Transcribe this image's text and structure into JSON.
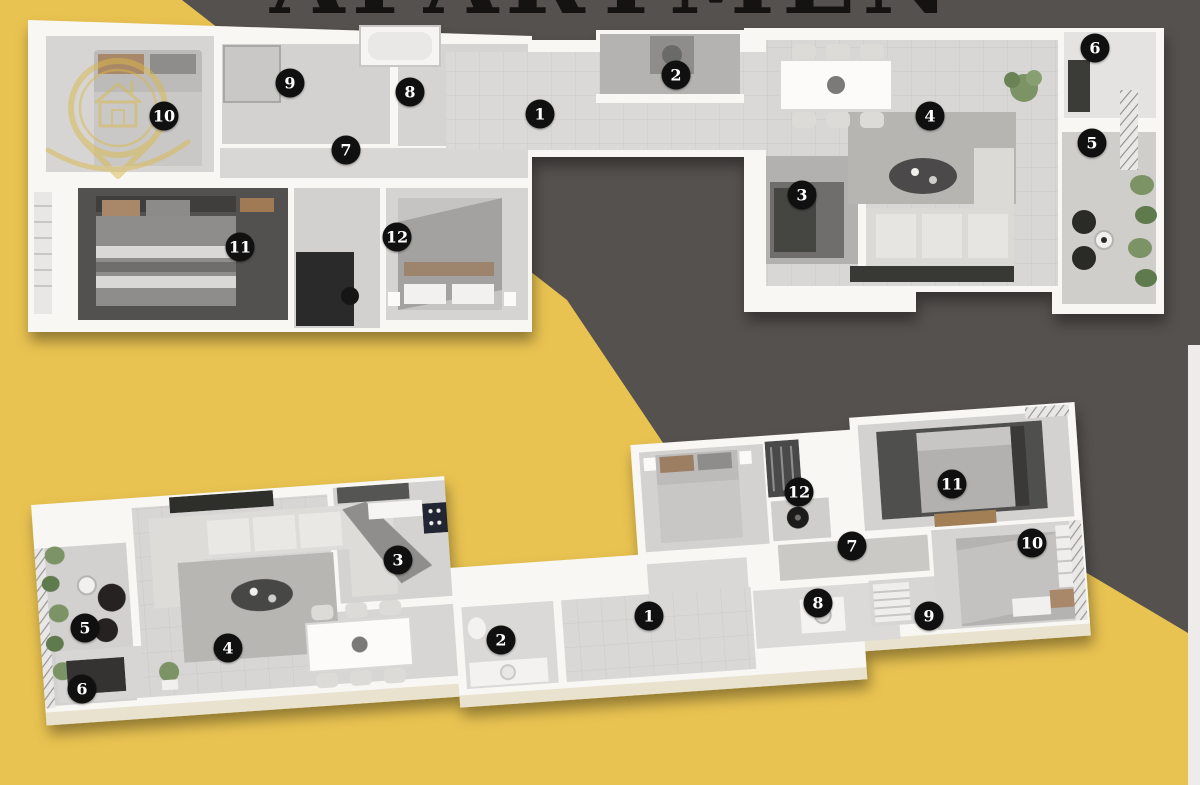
{
  "header": {
    "cropped_title_text": "APARTMENTS"
  },
  "watermark": {
    "icon": "location-pin-house-logo",
    "color": "#d9b94b"
  },
  "palette": {
    "background_yellow": "#e9c351",
    "background_dark": "#55514e",
    "right_edge_strip": "#edecea",
    "slab_white": "#f8f7f4",
    "marker_bg": "#101010",
    "marker_text": "#ffffff"
  },
  "top_plan": {
    "markers": [
      {
        "n": "1",
        "x": 540,
        "y": 114
      },
      {
        "n": "2",
        "x": 676,
        "y": 75
      },
      {
        "n": "3",
        "x": 802,
        "y": 195
      },
      {
        "n": "4",
        "x": 930,
        "y": 116
      },
      {
        "n": "5",
        "x": 1092,
        "y": 143
      },
      {
        "n": "6",
        "x": 1095,
        "y": 48
      },
      {
        "n": "7",
        "x": 346,
        "y": 150
      },
      {
        "n": "8",
        "x": 410,
        "y": 92
      },
      {
        "n": "9",
        "x": 290,
        "y": 83
      },
      {
        "n": "10",
        "x": 164,
        "y": 116
      },
      {
        "n": "11",
        "x": 240,
        "y": 247
      },
      {
        "n": "12",
        "x": 397,
        "y": 237
      }
    ]
  },
  "bottom_plan": {
    "markers": [
      {
        "n": "1",
        "x": 649,
        "y": 616
      },
      {
        "n": "2",
        "x": 501,
        "y": 640
      },
      {
        "n": "3",
        "x": 398,
        "y": 560
      },
      {
        "n": "4",
        "x": 228,
        "y": 648
      },
      {
        "n": "5",
        "x": 85,
        "y": 628
      },
      {
        "n": "6",
        "x": 82,
        "y": 689
      },
      {
        "n": "7",
        "x": 852,
        "y": 546
      },
      {
        "n": "8",
        "x": 818,
        "y": 603
      },
      {
        "n": "9",
        "x": 929,
        "y": 616
      },
      {
        "n": "10",
        "x": 1032,
        "y": 543
      },
      {
        "n": "11",
        "x": 952,
        "y": 484
      },
      {
        "n": "12",
        "x": 799,
        "y": 492
      }
    ]
  }
}
